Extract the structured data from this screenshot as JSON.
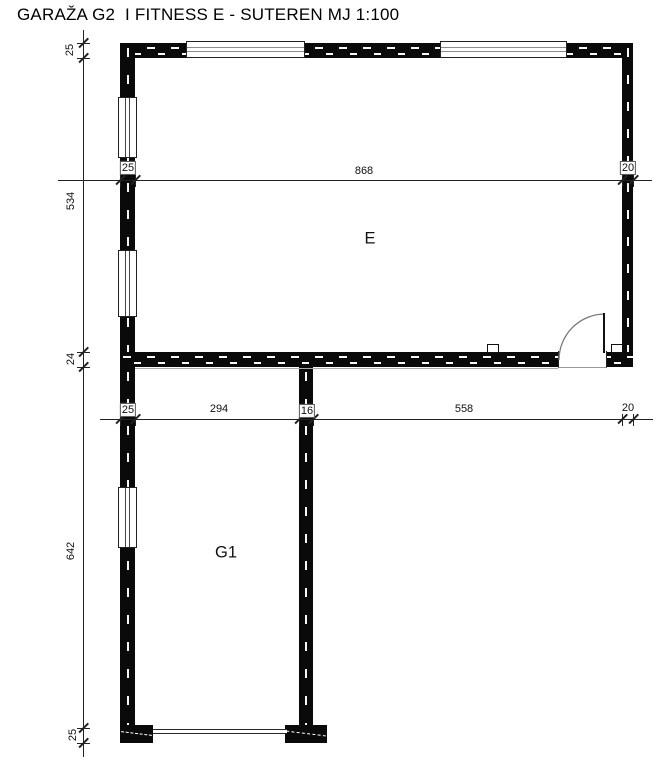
{
  "title": "GARAŽA G2  I FITNESS E - SUTEREN MJ 1:100",
  "rooms": {
    "e": "E",
    "g1": "G1"
  },
  "dims": {
    "top": [
      "25",
      "868",
      "20"
    ],
    "mid": [
      "25",
      "294",
      "16",
      "558",
      "20"
    ],
    "left": [
      "25",
      "534",
      "24",
      "642",
      "25"
    ]
  },
  "colors": {
    "wall": "#0a0a0a",
    "dim_line": "#222222",
    "glass": "#8c8c8c",
    "background": "#ffffff",
    "text": "#111111"
  }
}
